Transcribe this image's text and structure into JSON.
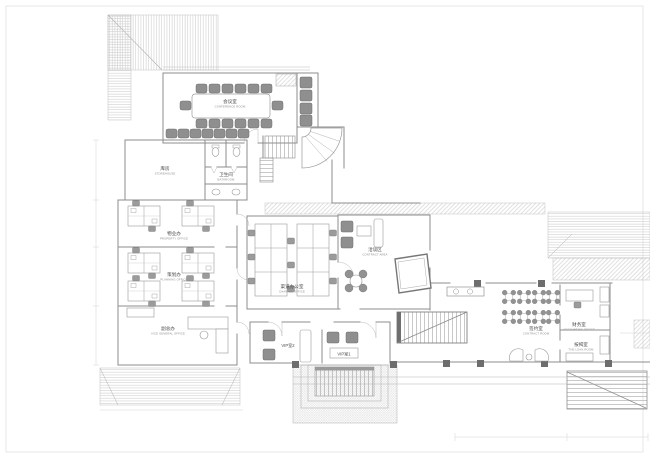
{
  "page": {
    "type": "architectural-floor-plan",
    "background": "#ffffff",
    "sheet_border_color": "#e2e2e2"
  },
  "palette": {
    "wall_line": "#8c8c8c",
    "light_line": "#c6c6c6",
    "furniture_fill": "#8f8f8f",
    "label_text": "#4a4a4a",
    "label_subtext": "#8d8d8d"
  },
  "rooms": {
    "conference": {
      "cn": "会议室",
      "en": "CONFERENCE ROOM"
    },
    "storehouse": {
      "cn": "库房",
      "en": "STOREHOUSE"
    },
    "bathroom": {
      "cn": "卫生间",
      "en": "BATHROOM"
    },
    "property": {
      "cn": "物业办",
      "en": "PROPERTY OFFICE"
    },
    "planning": {
      "cn": "策划办",
      "en": "PLANNING OFFICE"
    },
    "vice_general": {
      "cn": "副总办",
      "en": "VICE GENERAL OFFICE"
    },
    "channel": {
      "cn": "渠道办公室",
      "en": "CHANNEL OFFICE"
    },
    "contract_area": {
      "cn": "洽谈区",
      "en": "CONTRACT AREA"
    },
    "contract_room": {
      "cn": "签约室",
      "en": "CONTRACT ROOM"
    },
    "accounting": {
      "cn": "财务室",
      "en": "ACCOUNTING OFFICE"
    },
    "loan": {
      "cn": "按揭室",
      "en": "THE LOAN ROOM"
    },
    "vip2": {
      "cn": "VIP室2"
    },
    "vip1": {
      "cn": "VIP室1"
    }
  }
}
